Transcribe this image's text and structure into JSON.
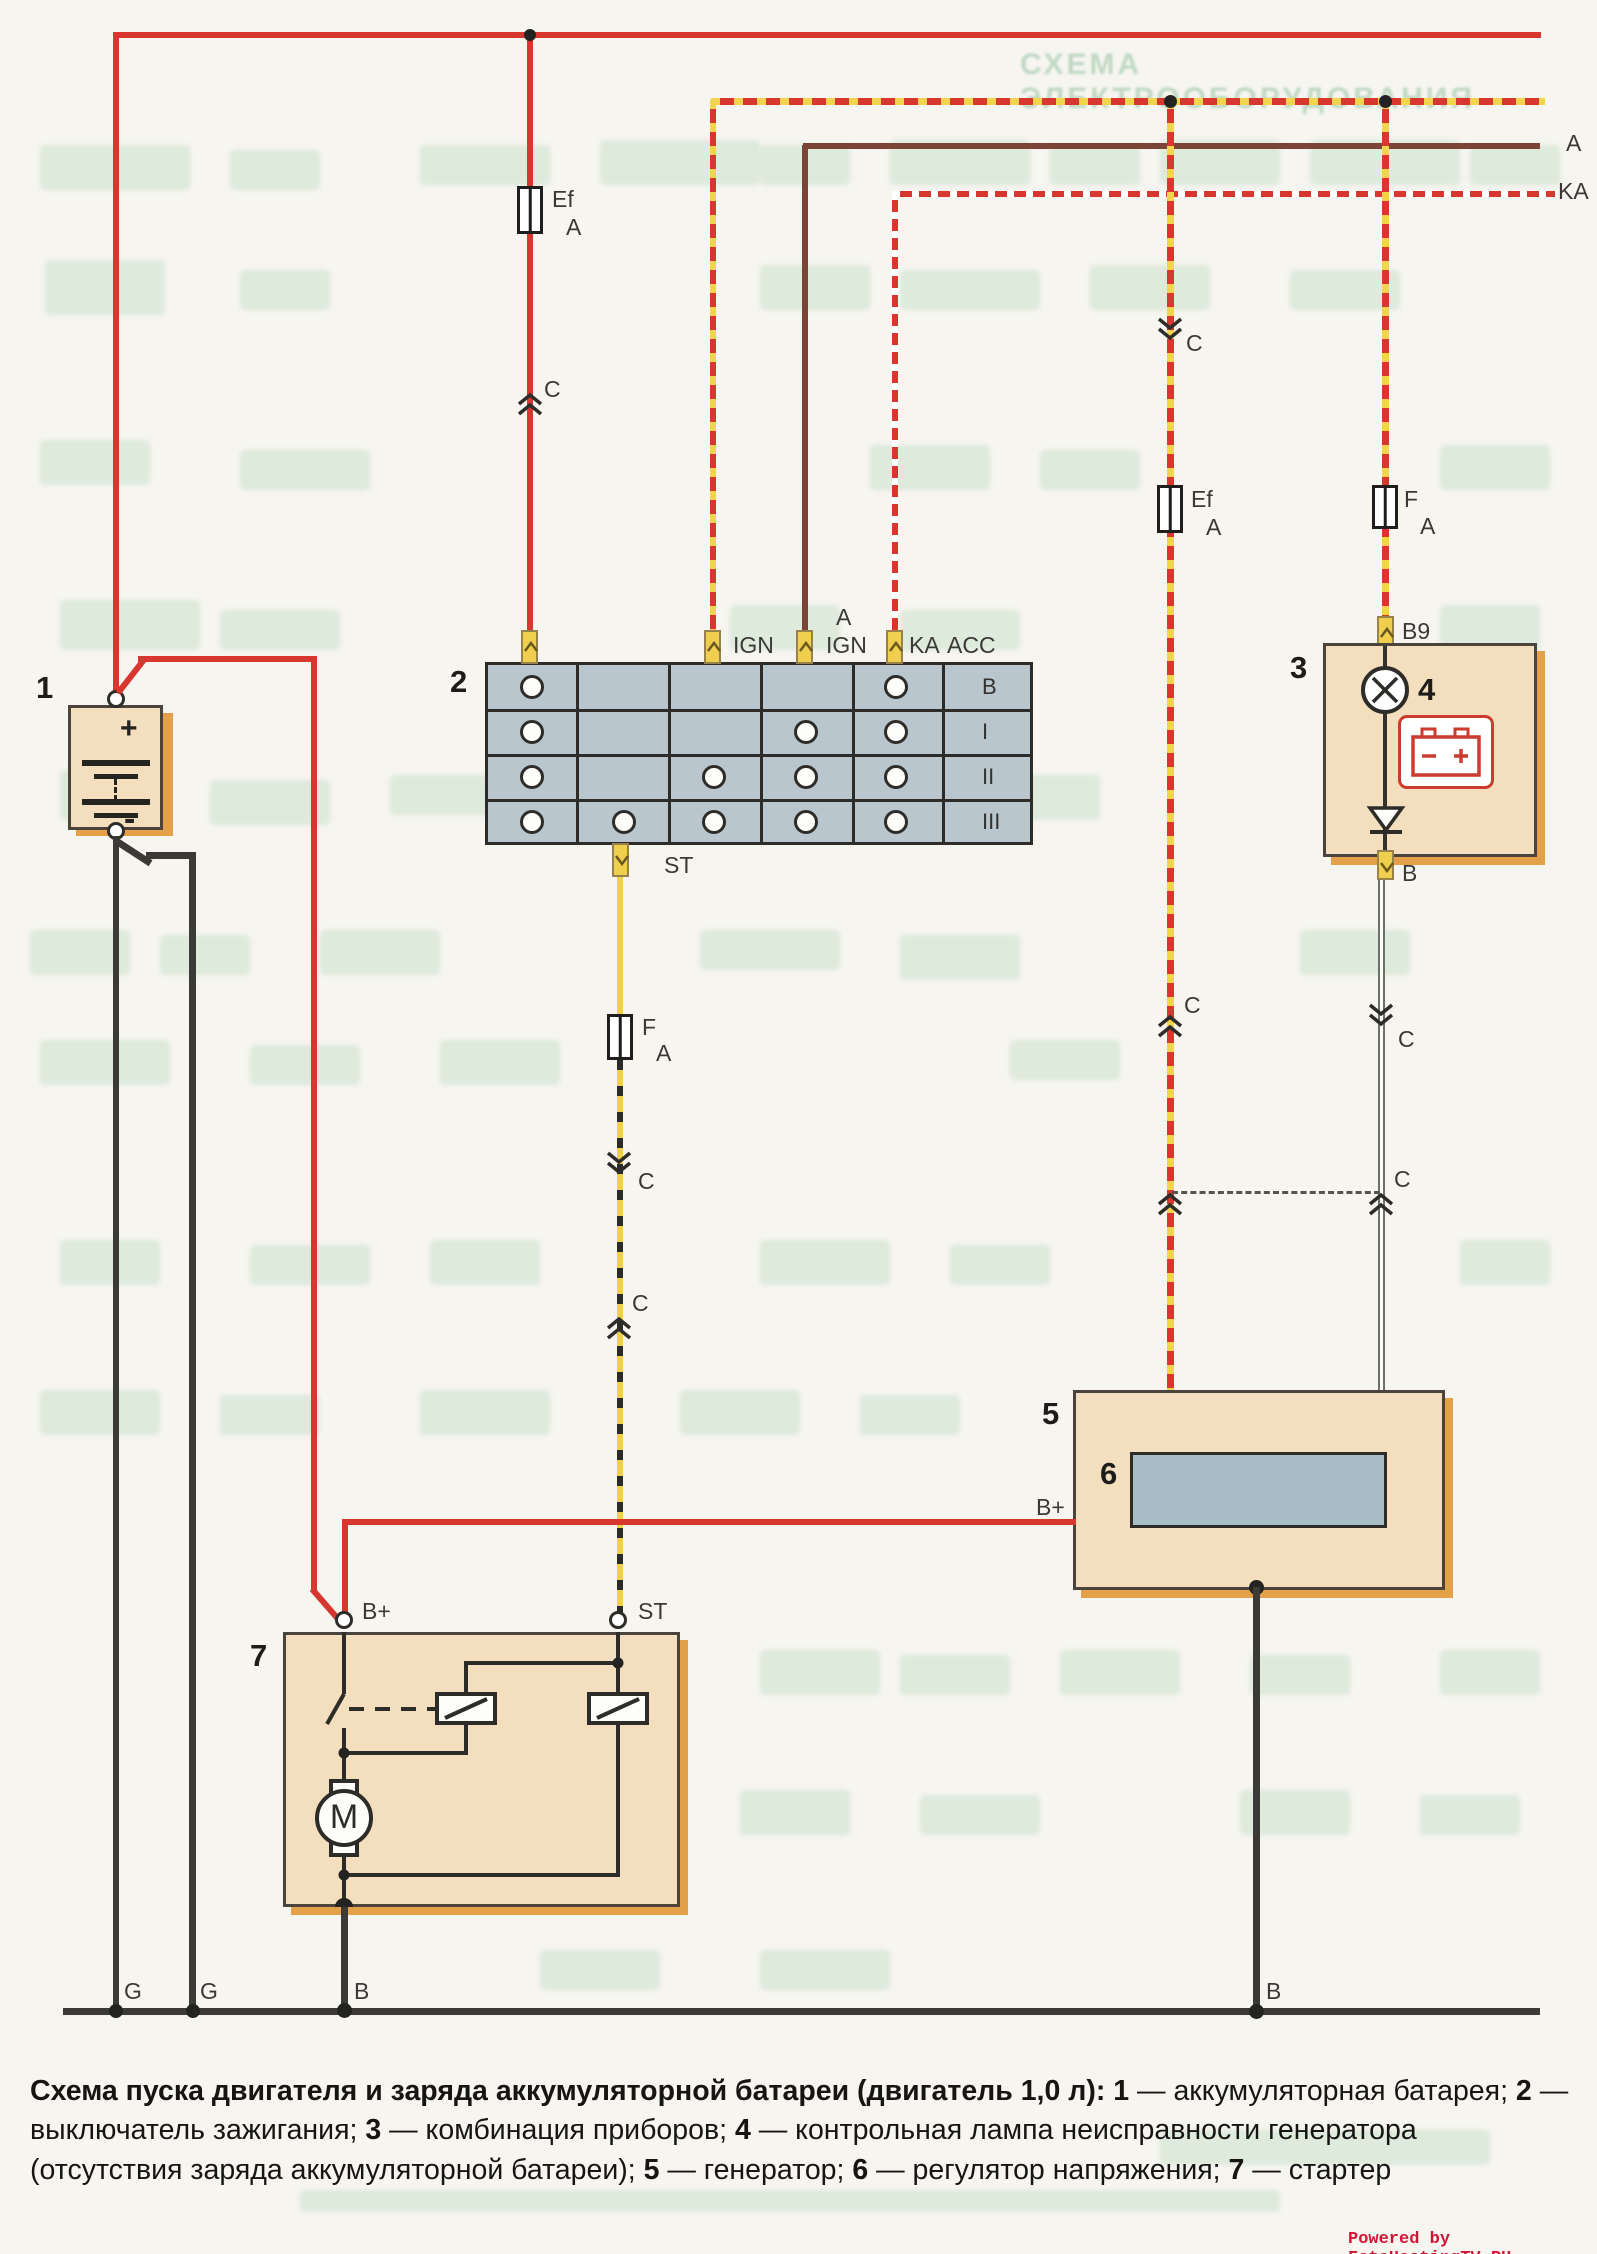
{
  "ghost_title": "СХЕМА ЭЛЕКТРООБОРУДОВАНИЯ",
  "watermark": "Powered by FotoHostingTV.RU",
  "colors": {
    "wire_red": "#d8372f",
    "wire_yellow": "#f0cf4e",
    "wire_brown": "#7c4437",
    "wire_dark": "#3b3a36",
    "component_tan": "#f3debd",
    "component_shadow": "#e5a04a",
    "switch_gray_blue": "#b9c6ce",
    "regulator_blue": "#a9bdc7",
    "lamp_icon_red": "#cc3b2f",
    "watermark_red": "#d01535",
    "ghost_green": "#a5d0ad"
  },
  "labels": {
    "a": "A",
    "ka": "KA",
    "c": "C",
    "ef": "Ef",
    "f": "F",
    "amp": "A",
    "ign": "IGN",
    "acc": "ACC",
    "st": "ST",
    "b9": "B9",
    "b": "B",
    "b_plus": "B+",
    "g": "G",
    "m": "M",
    "plus": "+",
    "minus": "-"
  },
  "components": {
    "battery": {
      "id": "1"
    },
    "ignition_switch": {
      "id": "2",
      "row_labels": [
        "B",
        "I",
        "II",
        "III"
      ],
      "contacts": [
        [
          1,
          5
        ],
        [
          1,
          4,
          5
        ],
        [
          1,
          3,
          4,
          5
        ],
        [
          1,
          2,
          3,
          4,
          5
        ]
      ],
      "top_terminals": [
        "",
        "IGN",
        "A IGN",
        "KA ACC"
      ],
      "bottom_terminal": "ST"
    },
    "cluster": {
      "id": "3",
      "terminal_top": "B9",
      "terminal_bottom": "B"
    },
    "warning_lamp": {
      "id": "4"
    },
    "generator": {
      "id": "5",
      "terminal": "B+"
    },
    "regulator": {
      "id": "6"
    },
    "starter": {
      "id": "7",
      "terminal_left": "B+",
      "terminal_right": "ST"
    }
  },
  "caption": {
    "lead": "Схема пуска двигателя и заряда аккумуляторной батареи (двигатель 1,0 л): ",
    "items": [
      {
        "n": "1",
        "t": " — аккумуляторная батарея; "
      },
      {
        "n": "2",
        "t": " — выключатель зажигания; "
      },
      {
        "n": "3",
        "t": " — комбинация приборов; "
      },
      {
        "n": "4",
        "t": " — контрольная лампа неисправности генератора (отсутствия заряда аккумуляторной батареи); "
      },
      {
        "n": "5",
        "t": " — генератор; "
      },
      {
        "n": "6",
        "t": " — регулятор напряжения; "
      },
      {
        "n": "7",
        "t": " — стартер"
      }
    ]
  }
}
